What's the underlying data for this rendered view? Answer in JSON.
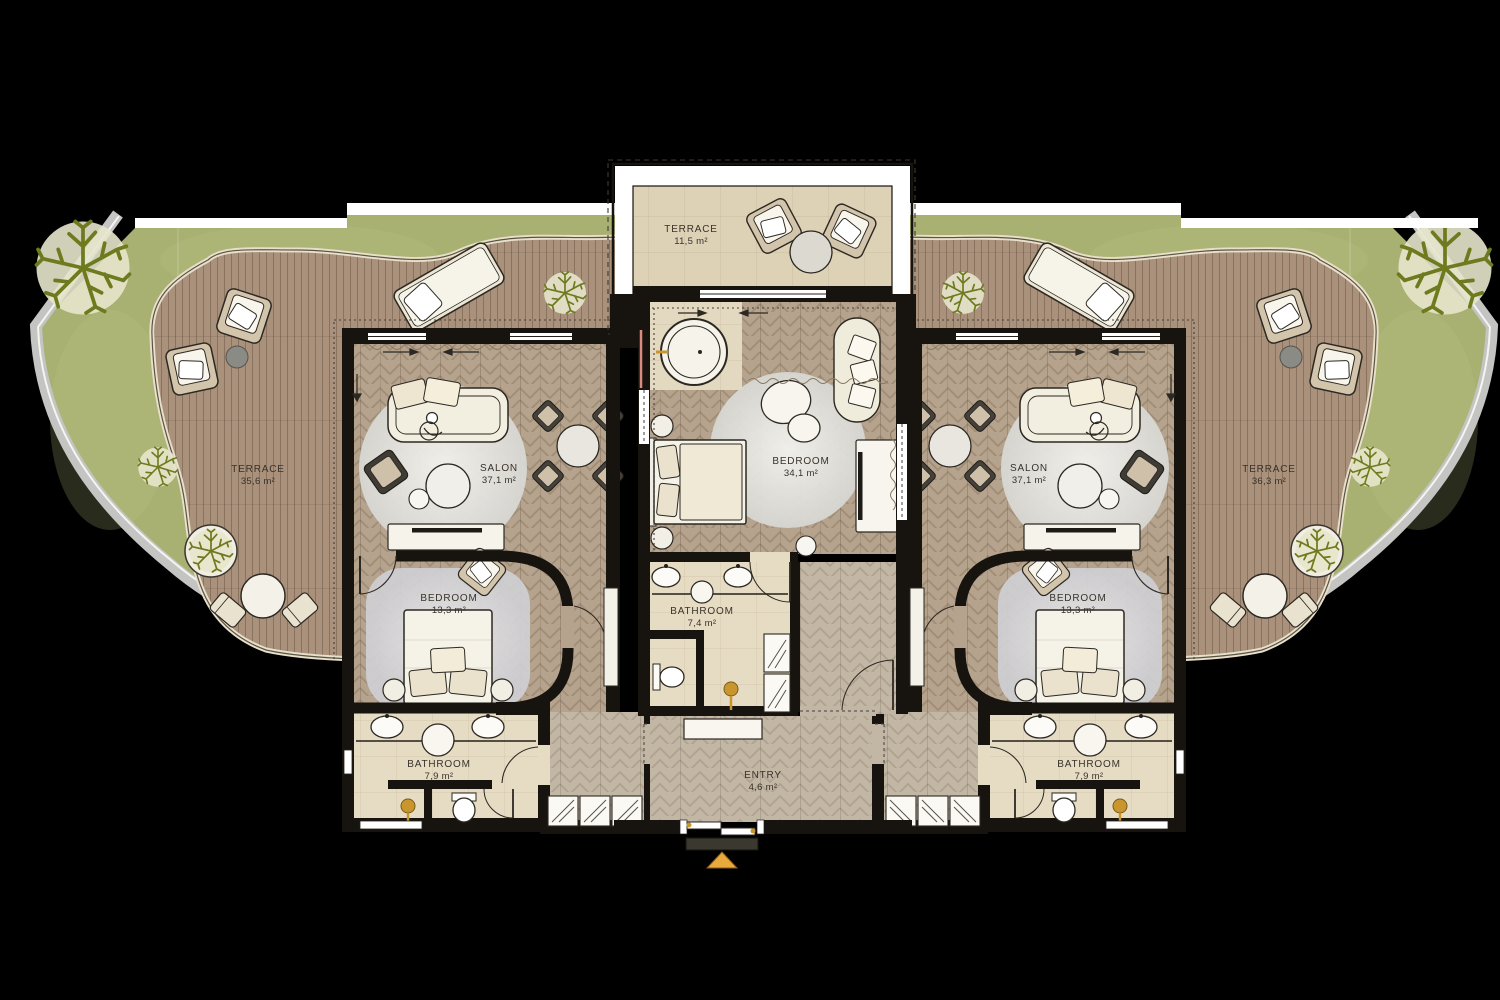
{
  "plan": {
    "rooms": {
      "terrace_top": {
        "name": "TERRACE",
        "area": "11,5 m²"
      },
      "terrace_left": {
        "name": "TERRACE",
        "area": "35,6 m²"
      },
      "terrace_right": {
        "name": "TERRACE",
        "area": "36,3 m²"
      },
      "salon_left": {
        "name": "SALON",
        "area": "37,1 m²"
      },
      "salon_right": {
        "name": "SALON",
        "area": "37,1 m²"
      },
      "bedroom_center": {
        "name": "BEDROOM",
        "area": "34,1 m²"
      },
      "bedroom_left": {
        "name": "BEDROOM",
        "area": "13,3 m²"
      },
      "bedroom_right": {
        "name": "BEDROOM",
        "area": "13,3 m²"
      },
      "bathroom_center": {
        "name": "BATHROOM",
        "area": "7,4 m²"
      },
      "bathroom_left": {
        "name": "BATHROOM",
        "area": "7,9 m²"
      },
      "bathroom_right": {
        "name": "BATHROOM",
        "area": "7,9 m²"
      },
      "entry": {
        "name": "ENTRY",
        "area": "4,6 m²"
      }
    },
    "markers": {
      "entry_marker": {
        "icon": "triangle-up",
        "color": "#e9a93d"
      }
    },
    "colors": {
      "background": "#000000",
      "garden": "#a9b172",
      "deck_wood": "#a9917b",
      "interior_wood": "#b5a38d",
      "hall_wood": "#c2b6a5",
      "stone_floor": "#e6dbc3",
      "terrace_stone": "#ddd1b6",
      "walls": "#17130e",
      "white_band": "#ffffff",
      "rug": "#ececea",
      "tree": "#6e7a1e",
      "outer_border": "#c4c4c2",
      "accent_gold": "#c9962e",
      "accent_salmon": "#dd8b7e",
      "entry_marker": "#e9a93d"
    }
  }
}
